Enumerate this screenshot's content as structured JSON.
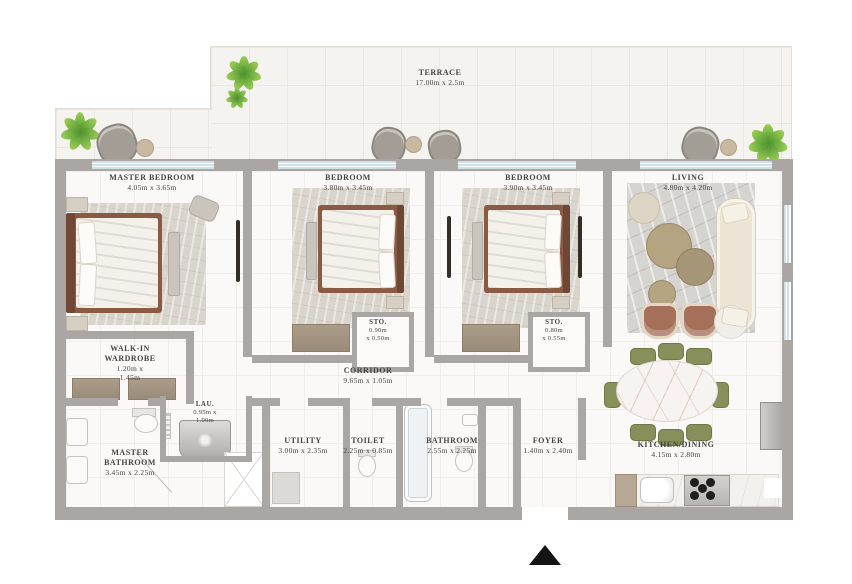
{
  "plan_title": "floor-plan",
  "north_arrow": "▲",
  "rooms": {
    "terrace": {
      "name": "TERRACE",
      "dims": "17.00m x 2.5m"
    },
    "master_bedroom": {
      "name": "MASTER BEDROOM",
      "dims": "4.05m x 3.65m"
    },
    "bedroom_2": {
      "name": "BEDROOM",
      "dims": "3.80m x 3.45m"
    },
    "bedroom_3": {
      "name": "BEDROOM",
      "dims": "3.90m x 3.45m"
    },
    "living": {
      "name": "LIVING",
      "dims": "4.80m x 4.20m"
    },
    "storage_1": {
      "name": "STO.",
      "dims": "0.90m\nx 0.50m"
    },
    "storage_2": {
      "name": "STO.",
      "dims": "0.80m\nx 0.55m"
    },
    "corridor": {
      "name": "CORRIDOR",
      "dims": "9.65m x 1.05m"
    },
    "walk_in_wardrobe": {
      "name": "WALK-IN\nWARDROBE",
      "dims": "1.20m x\n1.45m"
    },
    "laundry": {
      "name": "LAU.",
      "dims": "0.95m x\n1.00m"
    },
    "master_bathroom": {
      "name": "MASTER\nBATHROOM",
      "dims": "3.45m x 2.25m"
    },
    "utility": {
      "name": "UTILITY",
      "dims": "3.00m x 2.35m"
    },
    "toilet": {
      "name": "TOILET",
      "dims": "2.25m x 0.85m"
    },
    "bathroom": {
      "name": "BATHROOM",
      "dims": "2.55m x 2.25m"
    },
    "foyer": {
      "name": "FOYER",
      "dims": "1.40m x 2.40m"
    },
    "kitchen_dining": {
      "name": "KITCHEN/DINING",
      "dims": "4.15m x 2.80m"
    }
  },
  "colors": {
    "wall": "#a9a6a4",
    "window_glass": "#cfe0e8",
    "terrace_floor": "#f5f3ef",
    "interior_floor": "#faf9f7",
    "bed_frame": "#8a5a43",
    "armchair_terracotta": "#a4705a",
    "dining_chair_olive": "#87905a",
    "plant_green": "#5a9e35",
    "label_text": "#46443f",
    "north_arrow": "#141414"
  }
}
